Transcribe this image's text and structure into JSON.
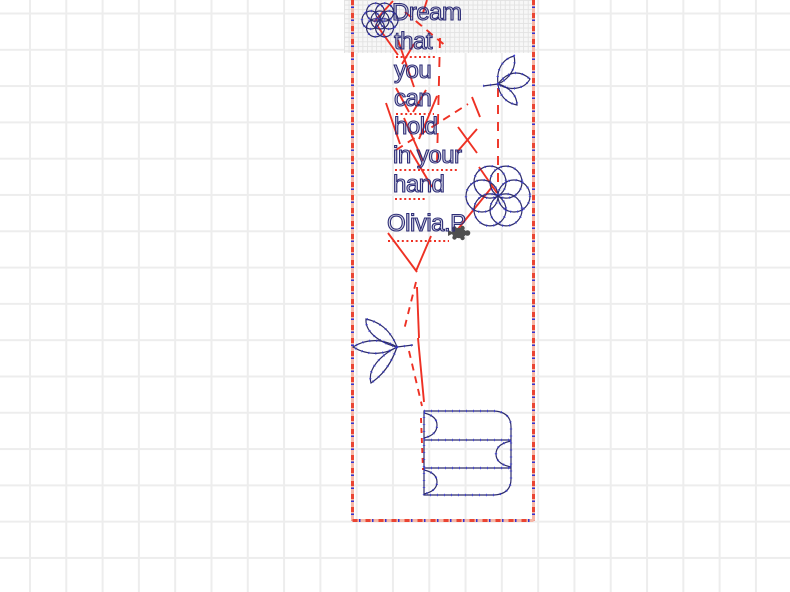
{
  "poem": {
    "lines": [
      "Dream",
      "that",
      "you",
      "can",
      "hold",
      "in your",
      "hand"
    ],
    "signature": "Olivia.P"
  },
  "icons": {
    "turtle": "turtle-sprite"
  },
  "colors": {
    "stitch_outline": "#2c2c6b",
    "stitch_point": "#3b3bdc",
    "jump_stitch": "#ee3124",
    "hoop_border_base": "#f6b7a7",
    "hoop_border_dash": "#ea4533",
    "hoop_border_point": "#3434d0",
    "grid_line": "#ededed",
    "turtle_sprite": "#4f4f4f",
    "background": "#ffffff"
  }
}
